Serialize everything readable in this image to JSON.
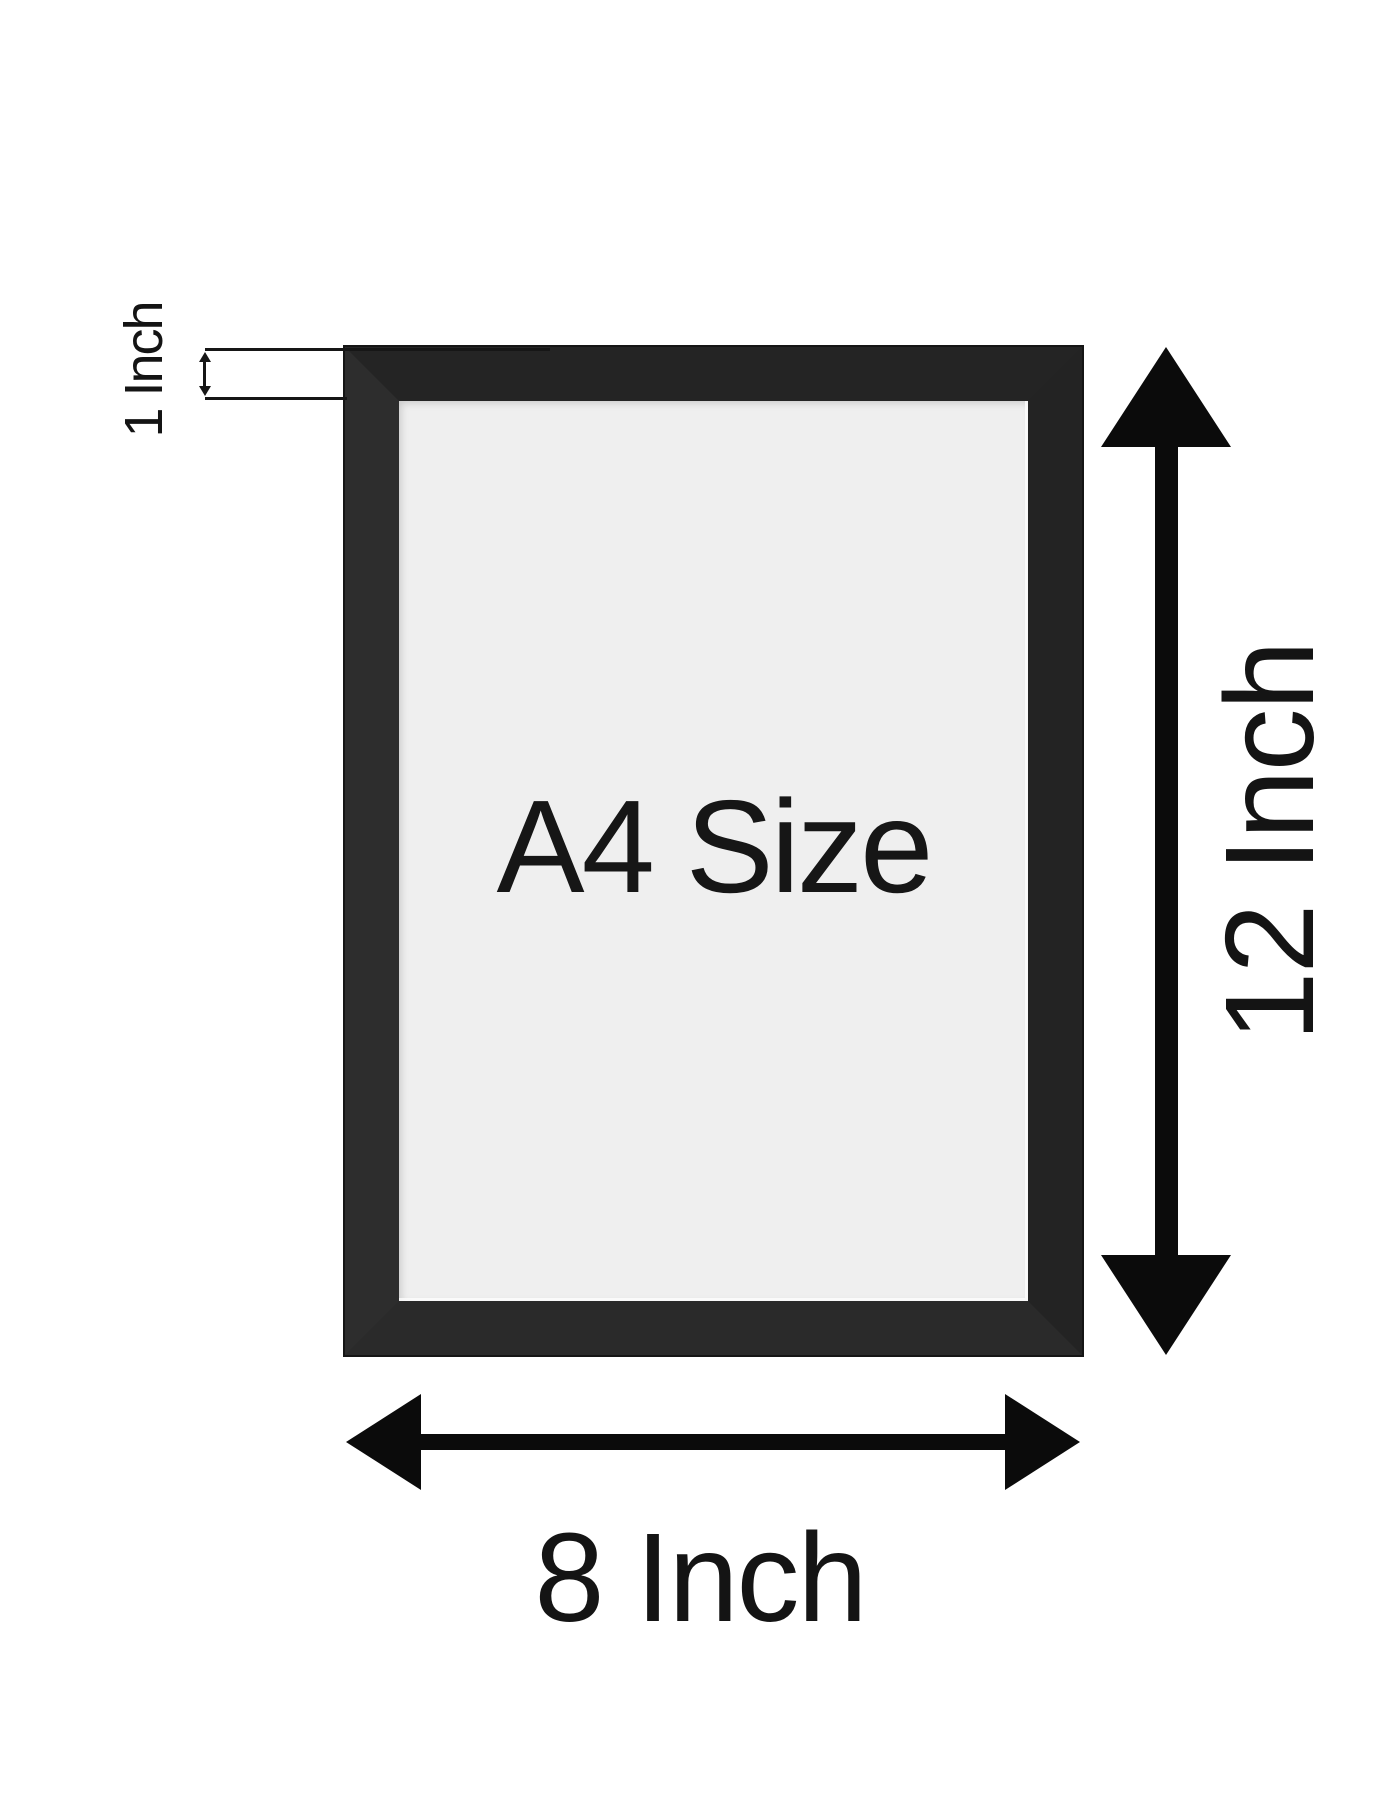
{
  "diagram": {
    "subject_label": "A4 Size",
    "dimensions": {
      "height_label": "12 Inch",
      "width_label": "8 Inch",
      "frame_border_label": "1 Inch"
    },
    "colors": {
      "background": "#ffffff",
      "frame": "#262626",
      "frame_interior": "#efefef",
      "arrow": "#0b0b0b",
      "text": "#141414"
    }
  }
}
